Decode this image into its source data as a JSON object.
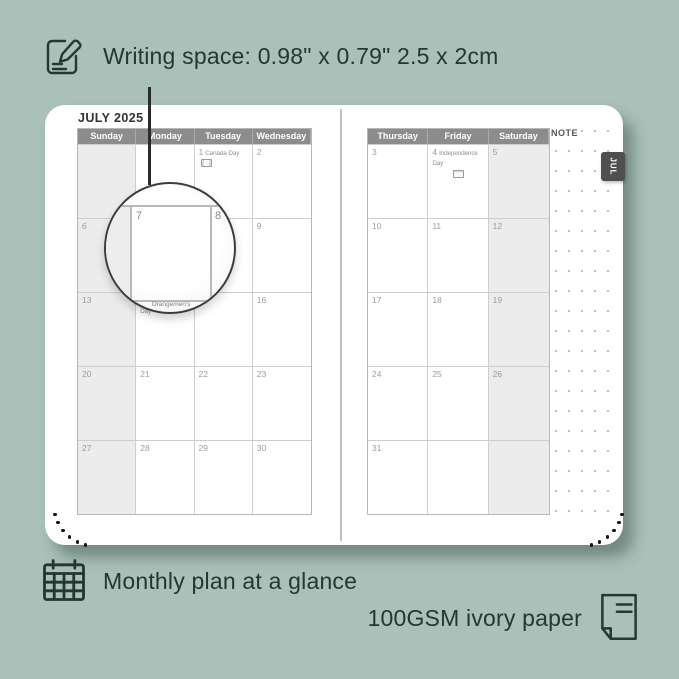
{
  "annotations": {
    "writing_space": "Writing space: 0.98\" x 0.79\" 2.5 x 2cm",
    "monthly_plan": "Monthly plan at a glance",
    "paper": "100GSM ivory paper"
  },
  "icons": [
    "note-pencil-icon",
    "calendar-grid-icon",
    "paper-sheet-icon"
  ],
  "colors": {
    "background": "#a9c1b9",
    "page": "#ffffff",
    "header_bg": "#8c8c8c",
    "weekend_bg": "#ececec",
    "grid_line": "#cecece",
    "date_text": "#9b9b9b",
    "ink": "#263632",
    "tab_bg": "#4f4f4f"
  },
  "planner": {
    "title": "JULY 2025",
    "tab_label": "JUL",
    "note_label": "NOTE",
    "left_page": {
      "headers": [
        "Sunday",
        "Monday",
        "Tuesday",
        "Wednesday"
      ],
      "weekend_col": 0,
      "rows": [
        [
          {
            "d": ""
          },
          {
            "d": ""
          },
          {
            "d": "1",
            "holiday": "Canada Day",
            "flag": "CA"
          },
          {
            "d": "2"
          }
        ],
        [
          {
            "d": "6"
          },
          {
            "d": "7"
          },
          {
            "d": "8"
          },
          {
            "d": "9"
          }
        ],
        [
          {
            "d": "13"
          },
          {
            "d": "14",
            "holiday": "Orangemen's Day"
          },
          {
            "d": "15"
          },
          {
            "d": "16"
          }
        ],
        [
          {
            "d": "20"
          },
          {
            "d": "21"
          },
          {
            "d": "22"
          },
          {
            "d": "23"
          }
        ],
        [
          {
            "d": "27"
          },
          {
            "d": "28"
          },
          {
            "d": "29"
          },
          {
            "d": "30"
          }
        ]
      ]
    },
    "right_page": {
      "headers": [
        "Thursday",
        "Friday",
        "Saturday"
      ],
      "weekend_col": 2,
      "rows": [
        [
          {
            "d": "3"
          },
          {
            "d": "4",
            "holiday": "Independence Day",
            "flag": "US"
          },
          {
            "d": "5"
          }
        ],
        [
          {
            "d": "10"
          },
          {
            "d": "11"
          },
          {
            "d": "12"
          }
        ],
        [
          {
            "d": "17"
          },
          {
            "d": "18"
          },
          {
            "d": "19"
          }
        ],
        [
          {
            "d": "24"
          },
          {
            "d": "25"
          },
          {
            "d": "26"
          }
        ],
        [
          {
            "d": "31"
          },
          {
            "d": ""
          },
          {
            "d": ""
          }
        ]
      ]
    },
    "lens": {
      "left_day": "7",
      "right_day": "8",
      "bottom_text": "Orangemen's"
    }
  }
}
